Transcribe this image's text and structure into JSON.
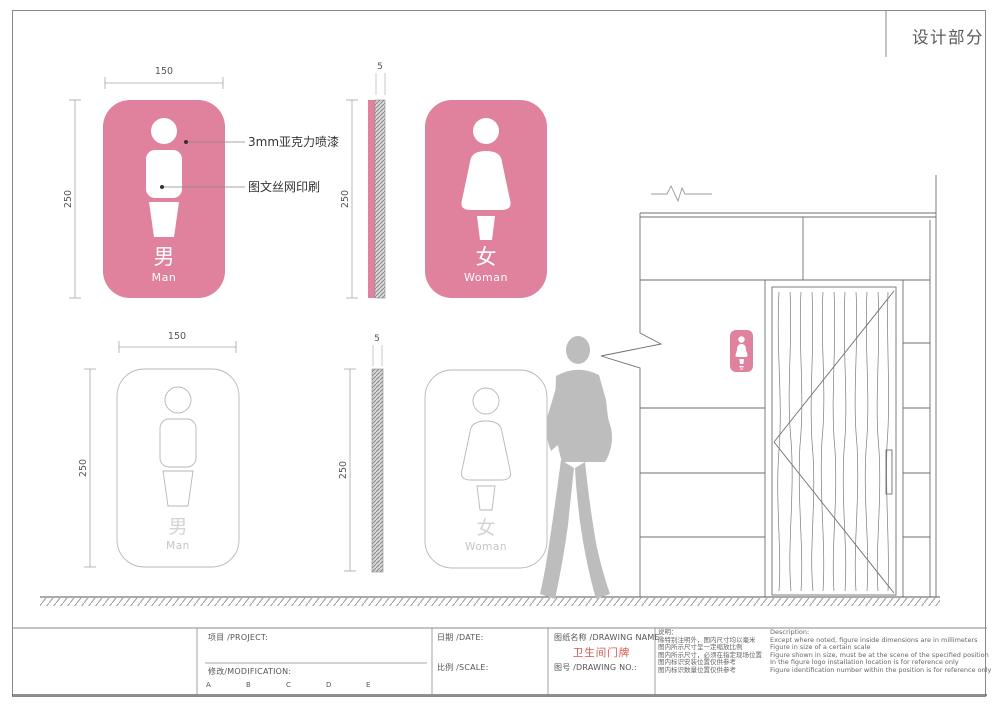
{
  "header": {
    "title": "设计部分"
  },
  "colors": {
    "pink": "#E0819E",
    "red": "#D8554A",
    "silhouette": "#BDBDBD"
  },
  "dims": {
    "width": "150",
    "height": "250",
    "thickness": "5"
  },
  "callouts": {
    "acrylic": "3mm亚克力喷漆",
    "silkscreen": "图文丝网印刷"
  },
  "signs": {
    "man": {
      "char": "男",
      "label": "Man"
    },
    "woman": {
      "char": "女",
      "label": "Woman"
    }
  },
  "titleblock": {
    "project": "项目 /PROJECT:",
    "modification": "修改/MODIFICATION:",
    "revisions": [
      "A",
      "B",
      "C",
      "D",
      "E"
    ],
    "date": "日期 /DATE:",
    "scale": "比例 /SCALE:",
    "drawing_name": "图纸名称 /DRAWING NAME:",
    "drawing_name_value": "卫生间门牌",
    "drawing_no": "图号 /DRAWING NO.:",
    "notes_cn": {
      "title": "说明：",
      "lines": [
        "除特别注明外，图内尺寸均以毫米",
        "图内所示尺寸呈一定缩放比例",
        "图内所示尺寸，必须在指定现场位置",
        "图内标识安装位置仅供参考",
        "图内标识数量位置仅供参考"
      ]
    },
    "notes_en": {
      "title": "Description:",
      "lines": [
        "Except where noted, figure inside dimensions are in millimeters",
        "Figure in size of a certain scale",
        "Figure shown in size, must be at the scene of the specified position",
        "In the figure logo installation location is for reference only",
        "Figure identification number within the position is for reference only"
      ]
    }
  }
}
